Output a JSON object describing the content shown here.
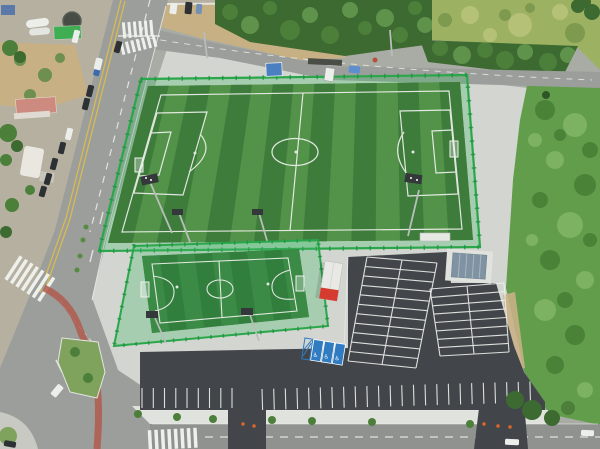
{
  "meta": {
    "title": "Aerial photograph of a public soccer complex: one full-size artificial-turf field, one small futsal field, and a newly paved parking lot beside roads and vegetation",
    "view": "top-down drone view"
  },
  "icons": {
    "wheelchair": "♿"
  },
  "colors": {
    "base": "#a9aba5",
    "land": "#b6b0a1",
    "dirt": "#c7b083",
    "meadow": "#9db163",
    "treesDark": "#3c6a30",
    "treesMid": "#4c7f3a",
    "treesLight": "#5f924a",
    "veg": "#629d4b",
    "vegDark": "#4a8238",
    "vegLight": "#7cb262",
    "apron": "#d3d5d0",
    "pad": "#e0e2dd",
    "road": "#9b9e9a",
    "roadDark": "#8f928e",
    "asphalt": "#42464a",
    "lineWhite": "#eef0ec",
    "lineYellow": "#d9ba52",
    "turfDark": "#3e7c3c",
    "turfLight": "#539349",
    "turfSmall": "#317e3d",
    "turfSmallLight": "#3b8a46",
    "fence": "#2aa64b",
    "fencePost": "#1e9440",
    "net": "rgba(72,190,110,0.32)",
    "white": "#f2f3f0",
    "red": "#d63b30",
    "blue": "#2f7cc2",
    "blueShed": "#4a7fc0",
    "container": "#7f93a3",
    "containerRidge": "#a7b6c2",
    "cone": "#e2662c",
    "carDark": "#2e3134",
    "carWhite": "#eceeec",
    "pathRed": "#b05a4e",
    "grassIsland": "#7fa35c",
    "steel": "#b9bdb9",
    "lampDark": "#34383a"
  },
  "scene": {
    "large_field": {
      "name": "large-soccer-field",
      "turf_stripes": 15,
      "floodlights": 4,
      "goals": 2
    },
    "small_field": {
      "name": "small-futsal-field",
      "floodlights": 2,
      "goals": 2
    },
    "parking": {
      "accessible_stalls": 3,
      "center_block_rows": 11,
      "east_block_rows": 8,
      "south_row_stalls_left": 8,
      "south_row_stalls_right": 23,
      "cones_main_entrance": 3,
      "cones_side_entrance": 2
    },
    "buildings": {
      "red_kiosk": 1,
      "container_unit": 1,
      "blue_shed": 1,
      "pavilion": 1
    },
    "vehicles": {
      "west_road_cars": 10,
      "south_road_cars": 3,
      "service_trucks": 2
    },
    "crosswalks": 4
  }
}
